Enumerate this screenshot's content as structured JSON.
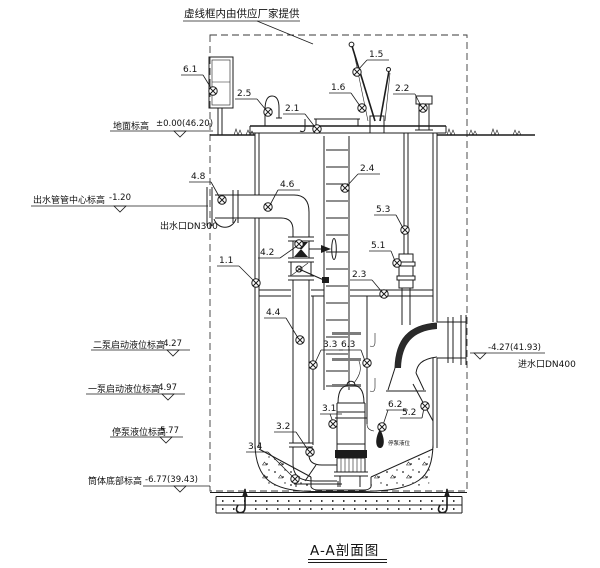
{
  "page": {
    "title": "A-A剖面图",
    "supplier_note": "虚线框内由供应厂家提供"
  },
  "elevations": {
    "ground_label": "地面标高",
    "ground_value": "±0.00(46.20)",
    "outlet_center_label": "出水管管中心标高",
    "outlet_center_value": "-1.20",
    "outlet_port": "出水口DN300",
    "pump2_start_label": "二泵启动液位标高",
    "pump2_start_value": "-4.27",
    "pump1_start_label": "一泵启动液位标高",
    "pump1_start_value": "-4.97",
    "pump_stop_label": "停泵液位标高",
    "pump_stop_value": "-5.77",
    "bottom_label": "筒体底部标高",
    "bottom_value": "-6.77(39.43)",
    "inlet_value": "-4.27(41.93)",
    "inlet_port": "进水口DN400",
    "float_tag": "停泵液位"
  },
  "callouts": [
    {
      "label": "6.1"
    },
    {
      "label": "2.5"
    },
    {
      "label": "2.1"
    },
    {
      "label": "1.5"
    },
    {
      "label": "1.6"
    },
    {
      "label": "2.2"
    },
    {
      "label": "4.8"
    },
    {
      "label": "4.6"
    },
    {
      "label": "2.4"
    },
    {
      "label": "5.3"
    },
    {
      "label": "1.1"
    },
    {
      "label": "4.2"
    },
    {
      "label": "5.1"
    },
    {
      "label": "2.3"
    },
    {
      "label": "4.4"
    },
    {
      "label": "3.3"
    },
    {
      "label": "6.3"
    },
    {
      "label": "3.1"
    },
    {
      "label": "6.2"
    },
    {
      "label": "5.2"
    },
    {
      "label": "3.2"
    },
    {
      "label": "3.4"
    }
  ],
  "colors": {
    "line": "#1c1c1c",
    "bracket_gray": "#7d7d7d",
    "background": "#ffffff"
  }
}
